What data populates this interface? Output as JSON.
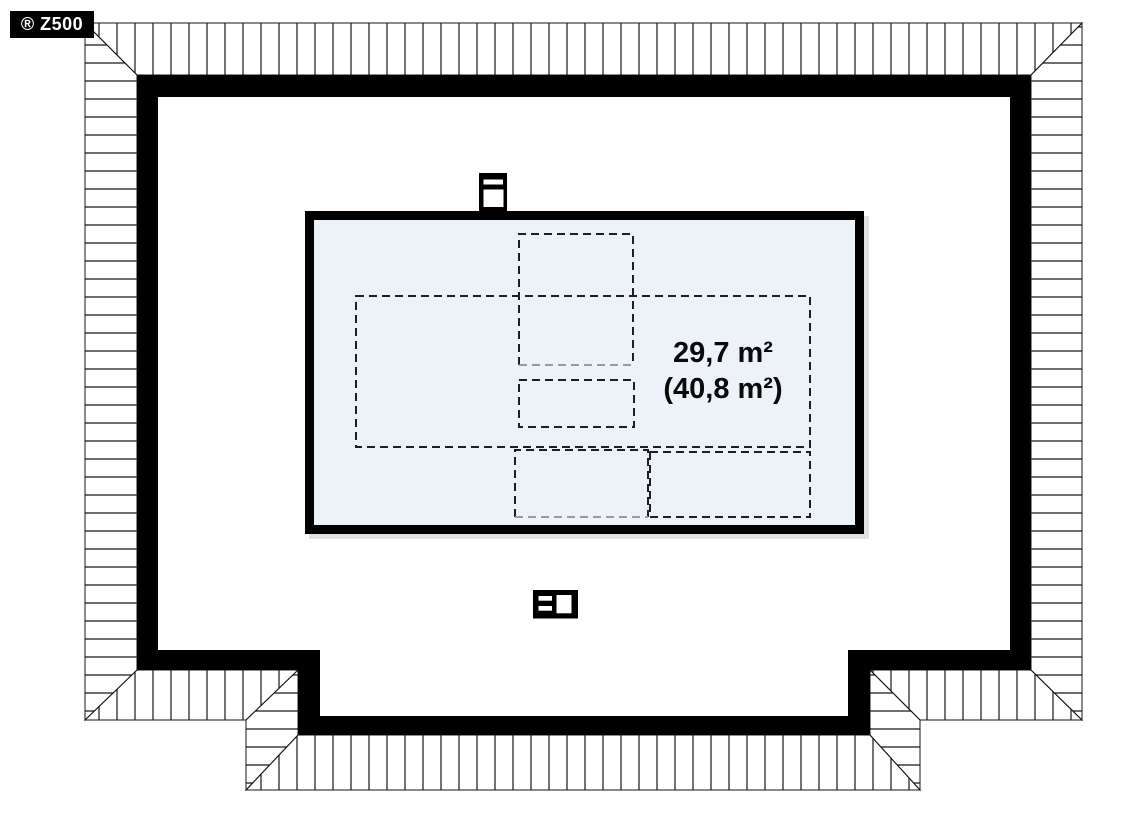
{
  "brand_badge": {
    "label": "® Z500",
    "background": "#000000",
    "text_color": "#ffffff"
  },
  "floor_plan": {
    "room": {
      "usable_area": "29,7 m²",
      "total_area": "(40,8 m²)",
      "floor_fill": "#edf2f8"
    },
    "colors": {
      "walls": "#000000",
      "roof_hatch_lines": "#161616",
      "dashed_dark": "#1f1f1f",
      "dashed_gray": "#9b9b9b",
      "background": "#ffffff"
    },
    "icons": [
      {
        "name": "chimney-icon-top"
      },
      {
        "name": "chimney-icon-bottom"
      }
    ]
  }
}
